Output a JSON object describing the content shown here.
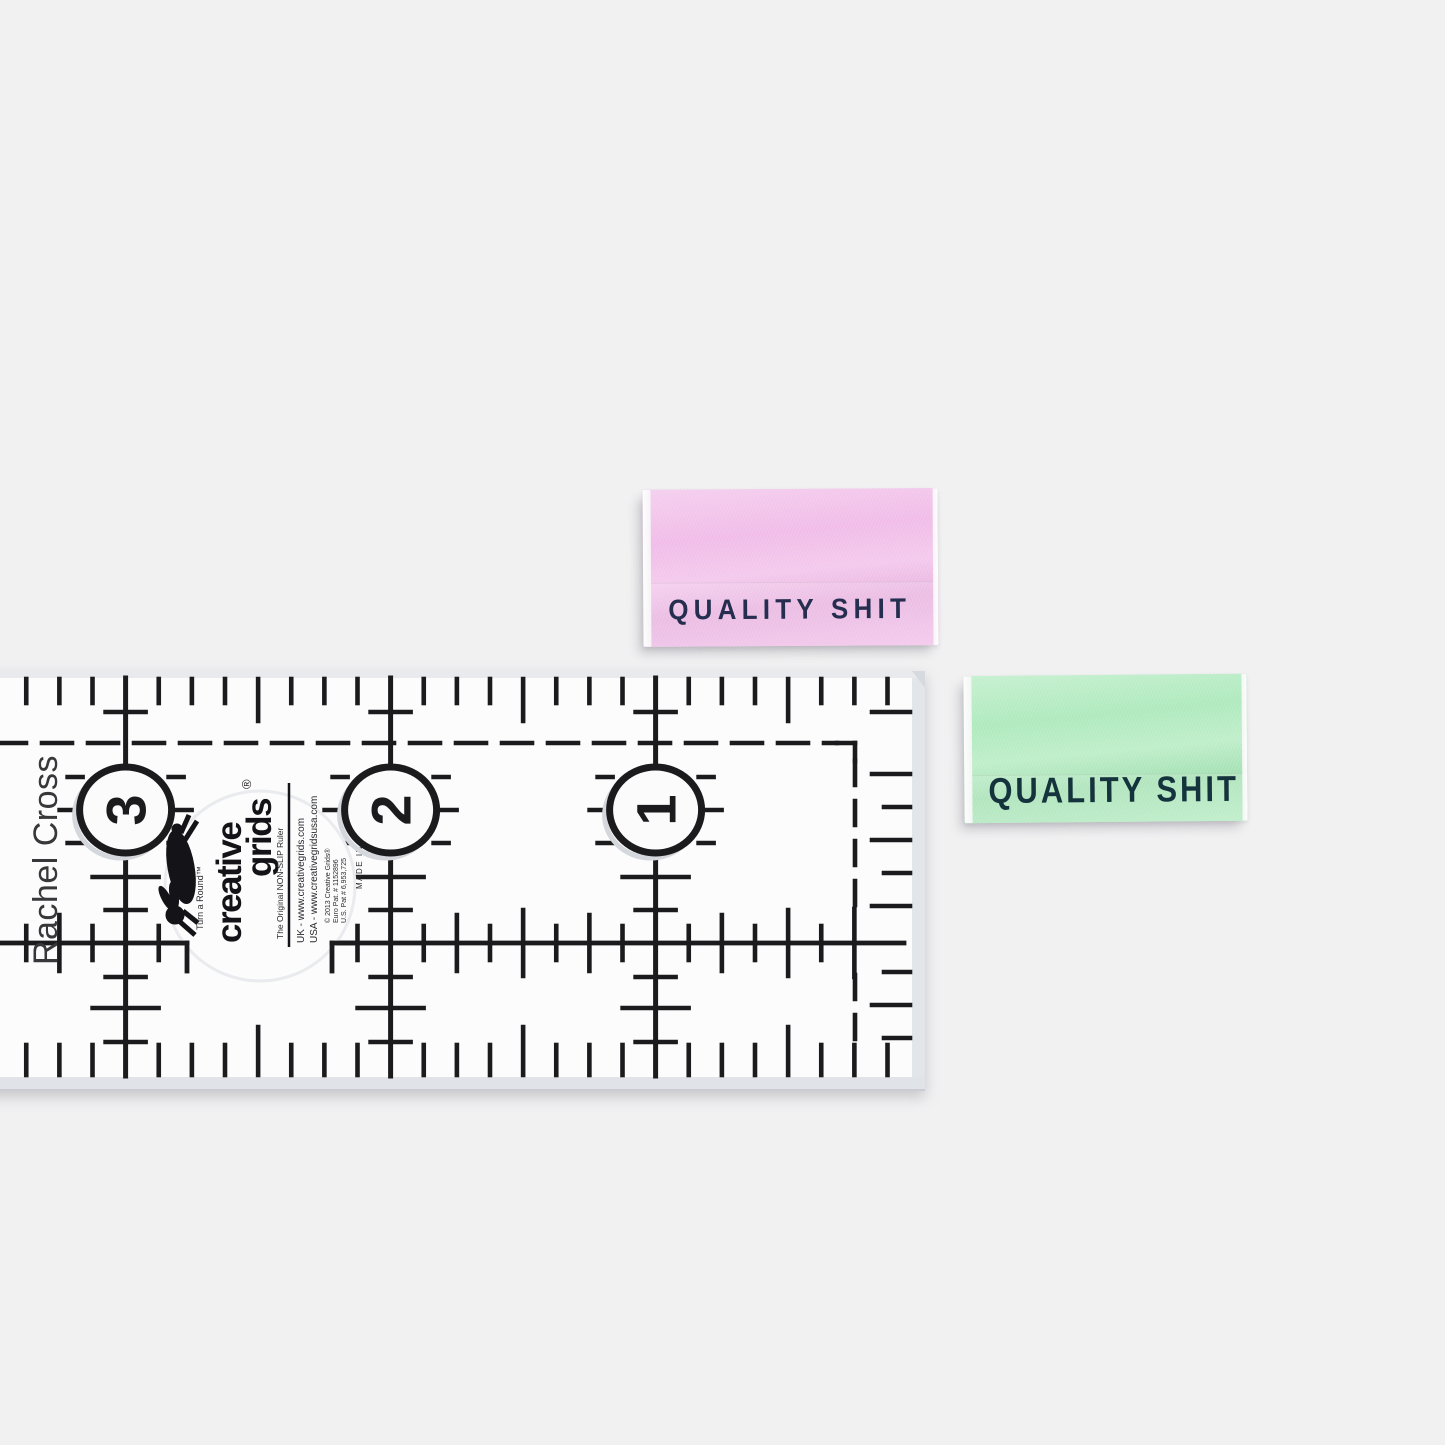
{
  "scene": {
    "background_color": "#f1f1f2"
  },
  "woven_labels": [
    {
      "color_name": "pink",
      "text": "QUALITY SHIT",
      "fabric_color": "#f0b9e7",
      "text_color": "#252e4e"
    },
    {
      "color_name": "green",
      "text": "QUALITY SHIT",
      "fabric_color": "#abe9ba",
      "text_color": "#14333c"
    }
  ],
  "ruler": {
    "maker_text": "Rachel Cross",
    "inch_numbers": [
      "3",
      "2",
      "1"
    ],
    "ink_color": "#1b1b1d",
    "brand": {
      "logo_line1": "creative",
      "logo_line2": "grids",
      "registered_mark": "®",
      "tagline_top": "Turn a Round™",
      "tagline_bottom": "The Original NON-SLIP Ruler",
      "website_uk": "UK - www.creativegrids.com",
      "website_usa": "USA - www.creativegridsusa.com",
      "copyright": "© 2013 Creative Grids®",
      "patent_line1": "Euro Pat. # 1152896",
      "patent_line2": "U.S. Pat # 6,953,725",
      "made_in": "MADE IN USA"
    }
  }
}
